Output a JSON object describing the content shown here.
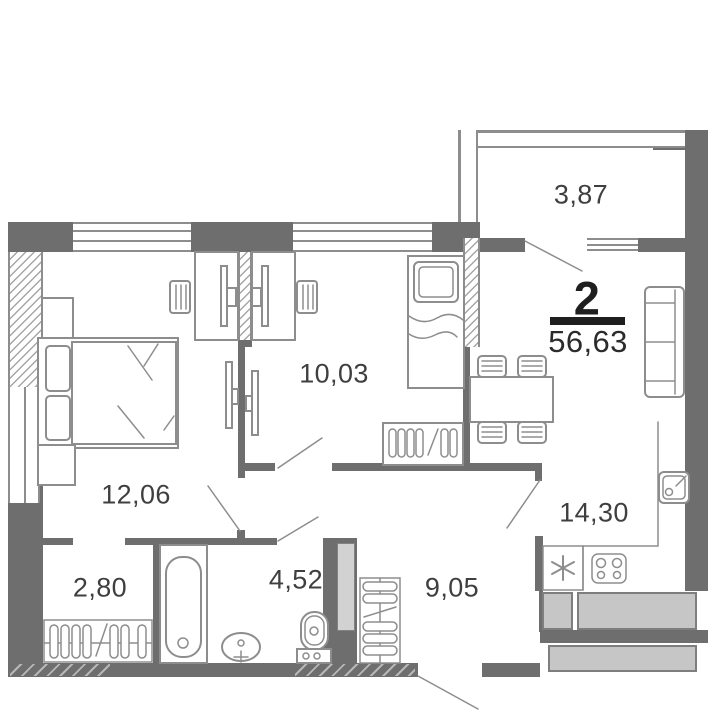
{
  "plan": {
    "apartment": {
      "rooms_count": "2",
      "total_area": "56,63"
    },
    "rooms": [
      {
        "id": "bedroom",
        "area": "12,06"
      },
      {
        "id": "room",
        "area": "10,03"
      },
      {
        "id": "wardrobe",
        "area": "2,80"
      },
      {
        "id": "bathroom",
        "area": "4,52"
      },
      {
        "id": "hallway",
        "area": "9,05"
      },
      {
        "id": "kitchen-living",
        "area": "14,30"
      },
      {
        "id": "balcony",
        "area": "3,87"
      }
    ],
    "symbols": [
      "double-bed",
      "single-bed",
      "desk",
      "office-chair",
      "tv",
      "monitor",
      "wardrobe-rail",
      "coat-rack",
      "bathtub",
      "washbasin",
      "toilet",
      "dining-table",
      "chair",
      "sofa",
      "kitchen-sink",
      "fridge",
      "hob",
      "window",
      "door-swing",
      "ventilation-shaft"
    ],
    "colors": {
      "bg": "#ffffff",
      "wall": "#6e6e6e",
      "line": "#8d8d8d",
      "hatch": "#a6a6a6",
      "fill_light": "#c6c6c6",
      "fill_shaft": "#d2d2d2",
      "text": "#3f3f3f",
      "accent": "#1f1f1f"
    }
  }
}
